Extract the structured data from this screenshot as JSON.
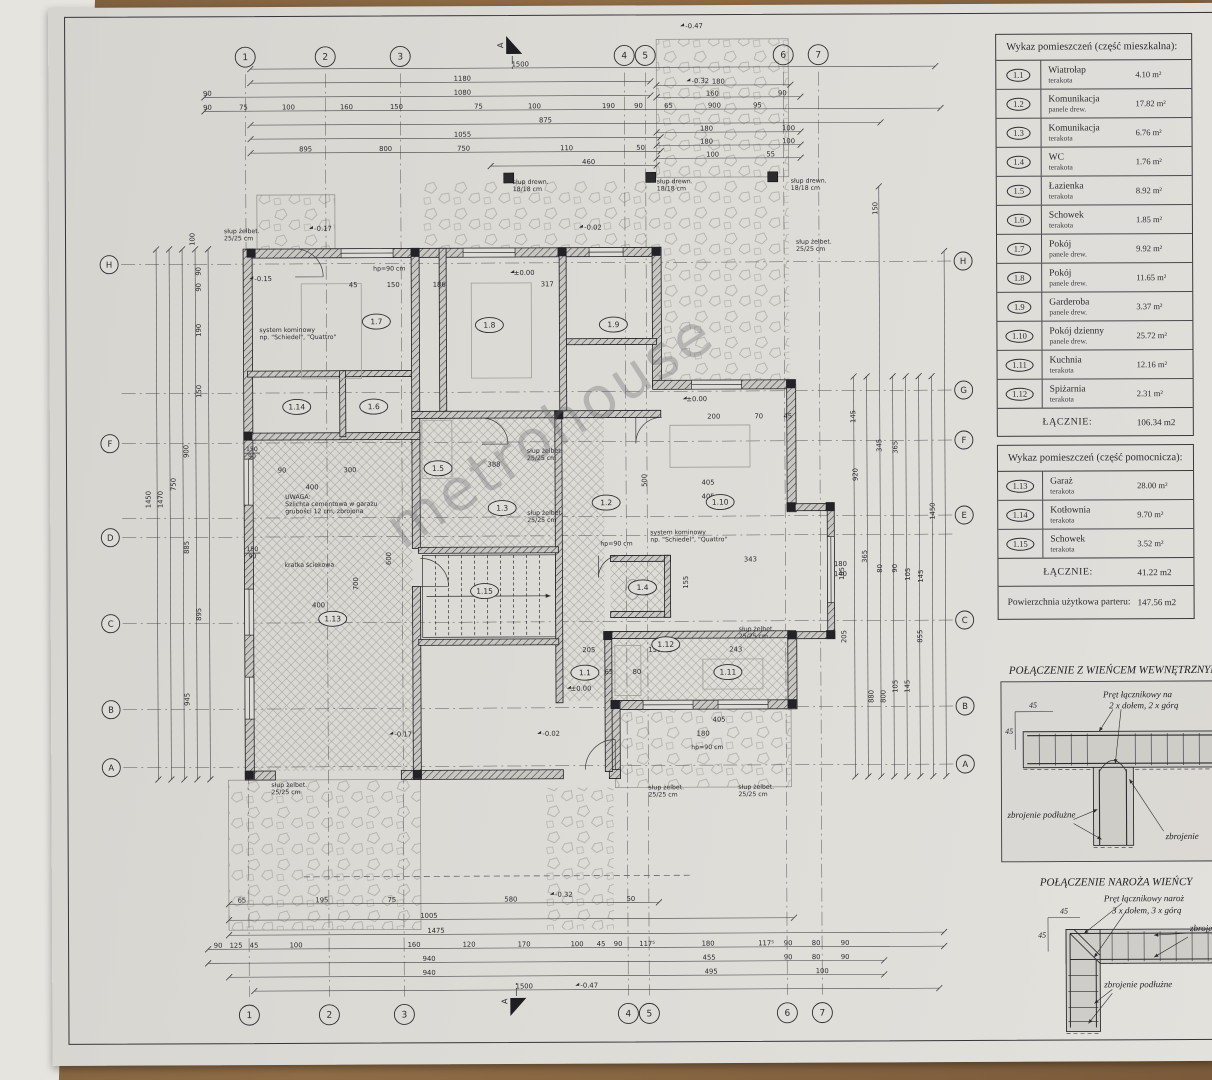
{
  "watermark": "metrohouse",
  "panel": {
    "main_table": {
      "title": "Wykaz pomieszczeń (część mieszkalna):",
      "rows": [
        {
          "no": "1.1",
          "name": "Wiatrołap",
          "finish": "terakota",
          "area": "4.10 m²"
        },
        {
          "no": "1.2",
          "name": "Komunikacja",
          "finish": "panele drew.",
          "area": "17.82 m²"
        },
        {
          "no": "1.3",
          "name": "Komunikacja",
          "finish": "terakota",
          "area": "6.76 m²"
        },
        {
          "no": "1.4",
          "name": "WC",
          "finish": "terakota",
          "area": "1.76 m²"
        },
        {
          "no": "1.5",
          "name": "Łazienka",
          "finish": "terakota",
          "area": "8.92 m²"
        },
        {
          "no": "1.6",
          "name": "Schowek",
          "finish": "terakota",
          "area": "1.85 m²"
        },
        {
          "no": "1.7",
          "name": "Pokój",
          "finish": "panele drew.",
          "area": "9.92 m²"
        },
        {
          "no": "1.8",
          "name": "Pokój",
          "finish": "panele drew.",
          "area": "11.65 m²"
        },
        {
          "no": "1.9",
          "name": "Garderoba",
          "finish": "panele drew.",
          "area": "3.37 m²"
        },
        {
          "no": "1.10",
          "name": "Pokój dzienny",
          "finish": "panele drew.",
          "area": "25.72 m²"
        },
        {
          "no": "1.11",
          "name": "Kuchnia",
          "finish": "terakota",
          "area": "12.16 m²"
        },
        {
          "no": "1.12",
          "name": "Spiżarnia",
          "finish": "terakota",
          "area": "2.31 m²"
        }
      ],
      "total_label": "ŁĄCZNIE:",
      "total_value": "106.34 m2"
    },
    "aux_table": {
      "title": "Wykaz pomieszczeń (część pomocnicza):",
      "rows": [
        {
          "no": "1.13",
          "name": "Garaż",
          "finish": "terakota",
          "area": "28.00 m²"
        },
        {
          "no": "1.14",
          "name": "Kotłownia",
          "finish": "terakota",
          "area": "9.70 m²"
        },
        {
          "no": "1.15",
          "name": "Schowek",
          "finish": "terakota",
          "area": "3.52 m²"
        }
      ],
      "total_label": "ŁĄCZNIE:",
      "total_value": "41.22 m2"
    },
    "footer_label": "Powierzchnia użytkowa parteru:",
    "footer_value": "147.56 m2"
  },
  "details": [
    {
      "title": "POŁĄCZENIE Z WIEŃCEM WEWNĘTRZNYM",
      "labels": {
        "rod": "Pręt łącznikowy na",
        "spec": "2 x dołem, 2 x górą",
        "long": "zbrojenie podłużne",
        "reinf": "zbrojenie",
        "dim": "45"
      }
    },
    {
      "title": "POŁĄCZENIE NAROŻA WIEŃCY",
      "labels": {
        "rod": "Pręt łącznikowy naroż",
        "spec": "3 x dołem, 3 x górą",
        "long": "zbrojenie podłużne",
        "reinf": "zbrojenie",
        "dim": "45"
      }
    }
  ],
  "plan": {
    "section_label": "A",
    "grid_cols": [
      {
        "l": "1",
        "x": 245
      },
      {
        "l": "2",
        "x": 325
      },
      {
        "l": "3",
        "x": 400
      },
      {
        "l": "4",
        "x": 624
      },
      {
        "l": "5",
        "x": 645
      },
      {
        "l": "6",
        "x": 783
      },
      {
        "l": "7",
        "x": 818
      }
    ],
    "grid_rows": [
      {
        "l": "H",
        "y": 265,
        "left": true,
        "right": true
      },
      {
        "l": "G",
        "y": 394,
        "left": false,
        "right": true
      },
      {
        "l": "F",
        "y": 444,
        "left": true,
        "right": true
      },
      {
        "l": "E",
        "y": 519,
        "left": false,
        "right": true
      },
      {
        "l": "D",
        "y": 538,
        "left": true,
        "right": false
      },
      {
        "l": "C",
        "y": 624,
        "left": true,
        "right": true
      },
      {
        "l": "B",
        "y": 710,
        "left": true,
        "right": true
      },
      {
        "l": "A",
        "y": 768,
        "left": true,
        "right": true
      }
    ],
    "rooms": [
      {
        "t": "1.7",
        "x": 375,
        "y": 323
      },
      {
        "t": "1.8",
        "x": 488,
        "y": 327
      },
      {
        "t": "1.9",
        "x": 612,
        "y": 327
      },
      {
        "t": "1.14",
        "x": 295,
        "y": 408
      },
      {
        "t": "1.6",
        "x": 372,
        "y": 408
      },
      {
        "t": "1.5",
        "x": 436,
        "y": 470
      },
      {
        "t": "1.3",
        "x": 500,
        "y": 510
      },
      {
        "t": "1.2",
        "x": 604,
        "y": 505
      },
      {
        "t": "1.10",
        "x": 718,
        "y": 505
      },
      {
        "t": "1.15",
        "x": 482,
        "y": 593
      },
      {
        "t": "1.4",
        "x": 640,
        "y": 590
      },
      {
        "t": "1.12",
        "x": 663,
        "y": 647
      },
      {
        "t": "1.13",
        "x": 330,
        "y": 620
      },
      {
        "t": "1.1",
        "x": 582,
        "y": 675
      },
      {
        "t": "1.11",
        "x": 725,
        "y": 675
      }
    ],
    "dims": [
      {
        "t": "1500",
        "x": 520,
        "y": 70
      },
      {
        "t": "1180",
        "x": 462,
        "y": 84
      },
      {
        "t": "90",
        "x": 207,
        "y": 98
      },
      {
        "t": "1080",
        "x": 462,
        "y": 98
      },
      {
        "t": "90",
        "x": 207,
        "y": 112
      },
      {
        "t": "75",
        "x": 243,
        "y": 112
      },
      {
        "t": "100",
        "x": 288,
        "y": 112
      },
      {
        "t": "160",
        "x": 346,
        "y": 112
      },
      {
        "t": "150",
        "x": 396,
        "y": 112
      },
      {
        "t": "75",
        "x": 478,
        "y": 112
      },
      {
        "t": "100",
        "x": 534,
        "y": 112
      },
      {
        "t": "190",
        "x": 608,
        "y": 112
      },
      {
        "t": "90",
        "x": 638,
        "y": 112
      },
      {
        "t": "875",
        "x": 545,
        "y": 126
      },
      {
        "t": "1055",
        "x": 462,
        "y": 140
      },
      {
        "t": "895",
        "x": 305,
        "y": 154
      },
      {
        "t": "800",
        "x": 385,
        "y": 154
      },
      {
        "t": "750",
        "x": 463,
        "y": 154
      },
      {
        "t": "110",
        "x": 566,
        "y": 154
      },
      {
        "t": "50",
        "x": 640,
        "y": 154
      },
      {
        "t": "460",
        "x": 588,
        "y": 168
      },
      {
        "t": "180",
        "x": 718,
        "y": 88
      },
      {
        "t": "160",
        "x": 712,
        "y": 100
      },
      {
        "t": "90",
        "x": 782,
        "y": 100
      },
      {
        "t": "65",
        "x": 668,
        "y": 112
      },
      {
        "t": "900",
        "x": 714,
        "y": 112
      },
      {
        "t": "95",
        "x": 757,
        "y": 112
      },
      {
        "t": "180",
        "x": 706,
        "y": 135
      },
      {
        "t": "100",
        "x": 788,
        "y": 135
      },
      {
        "t": "180",
        "x": 706,
        "y": 148
      },
      {
        "t": "100",
        "x": 788,
        "y": 148
      },
      {
        "t": "100",
        "x": 712,
        "y": 161
      },
      {
        "t": "55",
        "x": 770,
        "y": 161
      },
      {
        "t": "65",
        "x": 238,
        "y": 905
      },
      {
        "t": "195",
        "x": 318,
        "y": 905
      },
      {
        "t": "75",
        "x": 388,
        "y": 905
      },
      {
        "t": "580",
        "x": 507,
        "y": 905
      },
      {
        "t": "50",
        "x": 627,
        "y": 905
      },
      {
        "t": "1005",
        "x": 425,
        "y": 921
      },
      {
        "t": "1475",
        "x": 432,
        "y": 936
      },
      {
        "t": "90",
        "x": 214,
        "y": 950
      },
      {
        "t": "125",
        "x": 232,
        "y": 950
      },
      {
        "t": "45",
        "x": 250,
        "y": 950
      },
      {
        "t": "100",
        "x": 292,
        "y": 950
      },
      {
        "t": "160",
        "x": 410,
        "y": 950
      },
      {
        "t": "120",
        "x": 465,
        "y": 950
      },
      {
        "t": "170",
        "x": 520,
        "y": 950
      },
      {
        "t": "100",
        "x": 573,
        "y": 950
      },
      {
        "t": "45",
        "x": 597,
        "y": 950
      },
      {
        "t": "90",
        "x": 614,
        "y": 950
      },
      {
        "t": "117⁵",
        "x": 643,
        "y": 950
      },
      {
        "t": "180",
        "x": 704,
        "y": 950
      },
      {
        "t": "117⁵",
        "x": 762,
        "y": 950
      },
      {
        "t": "90",
        "x": 784,
        "y": 950
      },
      {
        "t": "80",
        "x": 812,
        "y": 950
      },
      {
        "t": "90",
        "x": 841,
        "y": 950
      },
      {
        "t": "940",
        "x": 425,
        "y": 964
      },
      {
        "t": "455",
        "x": 705,
        "y": 964
      },
      {
        "t": "90",
        "x": 784,
        "y": 964
      },
      {
        "t": "80",
        "x": 812,
        "y": 964
      },
      {
        "t": "90",
        "x": 841,
        "y": 964
      },
      {
        "t": "940",
        "x": 425,
        "y": 978
      },
      {
        "t": "495",
        "x": 707,
        "y": 978
      },
      {
        "t": "100",
        "x": 818,
        "y": 978
      },
      {
        "t": "1500",
        "x": 520,
        "y": 992
      },
      {
        "t": "100",
        "x": 195,
        "y": 240,
        "r": 1
      },
      {
        "t": "90",
        "x": 201,
        "y": 272,
        "r": 1
      },
      {
        "t": "90",
        "x": 201,
        "y": 288,
        "r": 1
      },
      {
        "t": "190",
        "x": 201,
        "y": 331,
        "r": 1
      },
      {
        "t": "150",
        "x": 201,
        "y": 392,
        "r": 1
      },
      {
        "t": "900",
        "x": 188,
        "y": 452,
        "r": 1
      },
      {
        "t": "750",
        "x": 175,
        "y": 485,
        "r": 1
      },
      {
        "t": "1450",
        "x": 150,
        "y": 500,
        "r": 1
      },
      {
        "t": "1470",
        "x": 162,
        "y": 500,
        "r": 1
      },
      {
        "t": "885",
        "x": 188,
        "y": 548,
        "r": 1
      },
      {
        "t": "895",
        "x": 200,
        "y": 615,
        "r": 1
      },
      {
        "t": "945",
        "x": 188,
        "y": 700,
        "r": 1
      },
      {
        "t": "150",
        "x": 878,
        "y": 212,
        "r": 1
      },
      {
        "t": "145",
        "x": 855,
        "y": 420,
        "r": 1
      },
      {
        "t": "345",
        "x": 881,
        "y": 449,
        "r": 1
      },
      {
        "t": "365",
        "x": 897,
        "y": 451,
        "r": 1
      },
      {
        "t": "920",
        "x": 857,
        "y": 478,
        "r": 1
      },
      {
        "t": "365",
        "x": 866,
        "y": 560,
        "r": 1
      },
      {
        "t": "185",
        "x": 843,
        "y": 577,
        "r": 1
      },
      {
        "t": "80",
        "x": 881,
        "y": 572,
        "r": 1
      },
      {
        "t": "90",
        "x": 896,
        "y": 572,
        "r": 1
      },
      {
        "t": "105",
        "x": 909,
        "y": 578,
        "r": 1
      },
      {
        "t": "145",
        "x": 922,
        "y": 580,
        "r": 1
      },
      {
        "t": "1450",
        "x": 934,
        "y": 515,
        "r": 1
      },
      {
        "t": "880",
        "x": 872,
        "y": 700,
        "r": 1
      },
      {
        "t": "800",
        "x": 884,
        "y": 700,
        "r": 1
      },
      {
        "t": "105",
        "x": 896,
        "y": 690,
        "r": 1
      },
      {
        "t": "145",
        "x": 908,
        "y": 690,
        "r": 1
      },
      {
        "t": "855",
        "x": 921,
        "y": 640,
        "r": 1
      },
      {
        "t": "205",
        "x": 845,
        "y": 640,
        "r": 1
      },
      {
        "t": "90",
        "x": 280,
        "y": 475
      },
      {
        "t": "300",
        "x": 348,
        "y": 475
      },
      {
        "t": "388",
        "x": 492,
        "y": 470
      },
      {
        "t": "400",
        "x": 310,
        "y": 492
      },
      {
        "t": "400",
        "x": 316,
        "y": 610
      },
      {
        "t": "600",
        "x": 390,
        "y": 560,
        "r": 1
      },
      {
        "t": "700",
        "x": 357,
        "y": 585,
        "r": 1
      },
      {
        "t": "45",
        "x": 352,
        "y": 290
      },
      {
        "t": "150",
        "x": 392,
        "y": 290
      },
      {
        "t": "186",
        "x": 438,
        "y": 290
      },
      {
        "t": "317",
        "x": 546,
        "y": 290
      },
      {
        "t": "200",
        "x": 712,
        "y": 423
      },
      {
        "t": "70",
        "x": 757,
        "y": 423
      },
      {
        "t": "45",
        "x": 786,
        "y": 423
      },
      {
        "t": "405",
        "x": 706,
        "y": 489
      },
      {
        "t": "405",
        "x": 706,
        "y": 503
      },
      {
        "t": "500",
        "x": 646,
        "y": 483,
        "r": 1
      },
      {
        "t": "343",
        "x": 748,
        "y": 566
      },
      {
        "t": "155",
        "x": 687,
        "y": 585,
        "r": 1
      },
      {
        "t": "205",
        "x": 586,
        "y": 656
      },
      {
        "t": "150",
        "x": 652,
        "y": 656
      },
      {
        "t": "243",
        "x": 733,
        "y": 656
      },
      {
        "t": "65",
        "x": 606,
        "y": 678
      },
      {
        "t": "80",
        "x": 634,
        "y": 678
      },
      {
        "t": "405",
        "x": 716,
        "y": 726
      },
      {
        "t": "180",
        "x": 700,
        "y": 740
      },
      {
        "t": "180",
        "x": 838,
        "y": 571
      },
      {
        "t": "140",
        "x": 838,
        "y": 581
      }
    ],
    "levels": [
      {
        "t": "-0.47",
        "x": 694,
        "y": 31
      },
      {
        "t": "-0.32",
        "x": 700,
        "y": 86
      },
      {
        "t": "-0.17",
        "x": 322,
        "y": 232
      },
      {
        "t": "-0.15",
        "x": 262,
        "y": 282
      },
      {
        "t": "-0.02",
        "x": 592,
        "y": 232
      },
      {
        "t": "±0.00",
        "x": 523,
        "y": 277
      },
      {
        "t": "±0.00",
        "x": 695,
        "y": 404
      },
      {
        "t": "±0.00",
        "x": 578,
        "y": 693
      },
      {
        "t": "-0.17",
        "x": 400,
        "y": 738
      },
      {
        "t": "-0.02",
        "x": 548,
        "y": 738
      },
      {
        "t": "-0.32",
        "x": 560,
        "y": 899
      },
      {
        "t": "-0.47",
        "x": 585,
        "y": 990
      }
    ],
    "notes": [
      {
        "x": 283,
        "y": 500,
        "lines": [
          "UWAGA:",
          "Szlichta cementowa w garażu",
          "grubości 12 cm, zbrojona"
        ]
      },
      {
        "x": 282,
        "y": 568,
        "lines": [
          "kratka ściekowa"
        ]
      },
      {
        "x": 258,
        "y": 333,
        "lines": [
          "system kominowy",
          "np. \"Schiedel\", \"Quattro\""
        ]
      },
      {
        "x": 648,
        "y": 537,
        "lines": [
          "system kominowy",
          "np. \"Schiedel\", \"Quattro\""
        ]
      },
      {
        "x": 223,
        "y": 234,
        "lines": [
          "słup żelbet.",
          "25/25 cm"
        ]
      },
      {
        "x": 795,
        "y": 247,
        "lines": [
          "słup żelbet.",
          "25/25 cm"
        ]
      },
      {
        "x": 525,
        "y": 455,
        "lines": [
          "słup żelbet.",
          "25/25 cm"
        ]
      },
      {
        "x": 525,
        "y": 517,
        "lines": [
          "słup żelbet.",
          "25/25 cm"
        ]
      },
      {
        "x": 736,
        "y": 634,
        "lines": [
          "słup żelbet.",
          "25/25 cm"
        ]
      },
      {
        "x": 268,
        "y": 788,
        "lines": [
          "słup żelbet.",
          "25/25 cm"
        ]
      },
      {
        "x": 645,
        "y": 792,
        "lines": [
          "słup żelbet.",
          "25/25 cm"
        ]
      },
      {
        "x": 735,
        "y": 792,
        "lines": [
          "słup żelbet.",
          "25/25 cm"
        ]
      },
      {
        "x": 512,
        "y": 186,
        "lines": [
          "słup drewn.",
          "18/18 cm"
        ]
      },
      {
        "x": 656,
        "y": 186,
        "lines": [
          "słup drewn.",
          "18/18 cm"
        ]
      },
      {
        "x": 790,
        "y": 186,
        "lines": [
          "słup drewn.",
          "18/18 cm"
        ]
      },
      {
        "x": 372,
        "y": 272,
        "lines": [
          "hp=90 cm"
        ]
      },
      {
        "x": 598,
        "y": 548,
        "lines": [
          "hp=90 cm"
        ]
      },
      {
        "x": 688,
        "y": 752,
        "lines": [
          "hp=90 cm"
        ]
      },
      {
        "x": 250,
        "y": 452,
        "lines": [
          "150",
          "90"
        ],
        "frac": true
      },
      {
        "x": 250,
        "y": 552,
        "lines": [
          "150",
          "90"
        ],
        "frac": true
      }
    ],
    "columns_sq": [
      {
        "x": 250,
        "y": 254
      },
      {
        "x": 414,
        "y": 254
      },
      {
        "x": 561,
        "y": 254
      },
      {
        "x": 655,
        "y": 254
      },
      {
        "x": 789,
        "y": 387
      },
      {
        "x": 789,
        "y": 510
      },
      {
        "x": 828,
        "y": 510
      },
      {
        "x": 828,
        "y": 638
      },
      {
        "x": 789,
        "y": 638
      },
      {
        "x": 789,
        "y": 707
      },
      {
        "x": 612,
        "y": 707
      },
      {
        "x": 246,
        "y": 437
      },
      {
        "x": 246,
        "y": 776
      },
      {
        "x": 414,
        "y": 776
      },
      {
        "x": 557,
        "y": 417
      },
      {
        "x": 605,
        "y": 638
      }
    ],
    "posts_sq": [
      {
        "x": 508,
        "y": 180
      },
      {
        "x": 650,
        "y": 180
      },
      {
        "x": 772,
        "y": 180
      }
    ]
  }
}
